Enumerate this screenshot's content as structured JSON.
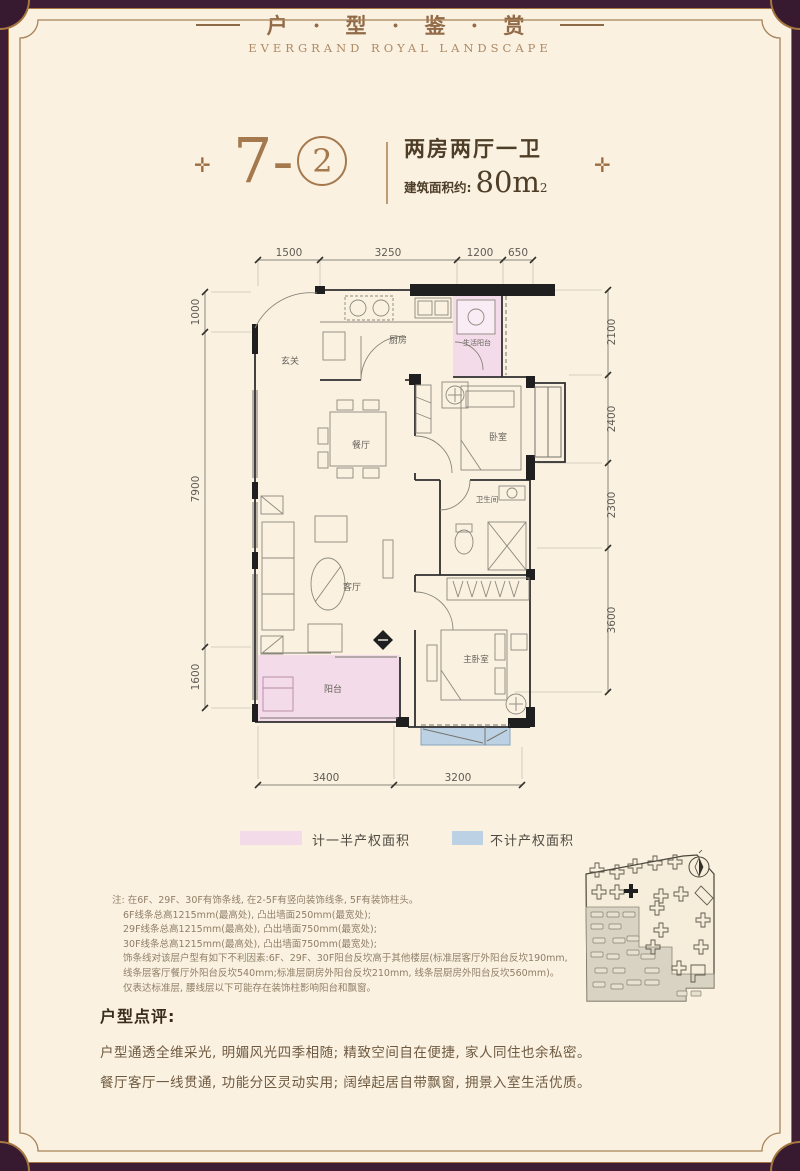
{
  "header": {
    "title": "户 · 型 · 鉴 · 赏",
    "subtitle": "EVERGRAND  ROYAL  LANDSCAPE"
  },
  "unit": {
    "ornament_left": "✛",
    "ornament_right": "✛",
    "number_prefix": "7-",
    "number_circled": "2",
    "type_text": "两房两厅一卫",
    "area_label": "建筑面积约:",
    "area_value": "80m",
    "area_sup": "2"
  },
  "floorplan": {
    "dims_top": [
      "1500",
      "3250",
      "1200",
      "650"
    ],
    "dims_left": [
      "1000",
      "7900",
      "1600"
    ],
    "dims_right": [
      "2100",
      "2400",
      "2300",
      "3600"
    ],
    "dims_bottom": [
      "3400",
      "3200"
    ],
    "rooms": {
      "entry": "玄关",
      "kitchen": "厨房",
      "service_balcony": "生活阳台",
      "dining": "餐厅",
      "bedroom": "卧室",
      "bathroom": "卫生间",
      "living": "客厅",
      "master_bedroom": "主卧室",
      "balcony": "阳台"
    },
    "colors": {
      "half_property": "#f4dbe9",
      "excluded": "#bcd2e4",
      "wall": "#1f1f1f"
    }
  },
  "legend": {
    "half_property": "计一半产权面积",
    "excluded": "不计产权面积"
  },
  "notes": {
    "lines": [
      "注: 在6F、29F、30F有饰条线, 在2-5F有竖向装饰线条, 5F有装饰柱头。",
      "6F线条总高1215mm(最高处), 凸出墙面250mm(最宽处);",
      "29F线条总高1215mm(最高处), 凸出墙面750mm(最宽处);",
      "30F线条总高1215mm(最高处), 凸出墙面750mm(最宽处);",
      "饰条线对该层户型有如下不利因素:6F、29F、30F阳台反坎高于其他楼层(标准层客厅外阳台反坎190mm,",
      "线条层客厅餐厅外阳台反坎540mm;标准层厨房外阳台反坎210mm, 线条层厨房外阳台反坎560mm)。",
      "仅表达标准层, 腰线层以下可能存在装饰柱影响阳台和飘窗。"
    ]
  },
  "review": {
    "heading": "户型点评:",
    "lines": [
      "户型通透全维采光, 明媚风光四季相随; 精致空间自在便捷, 家人同住也余私密。",
      "餐厅客厅一线贯通, 功能分区灵动实用; 阔绰起居自带飘窗, 拥景入室生活优质。"
    ]
  }
}
